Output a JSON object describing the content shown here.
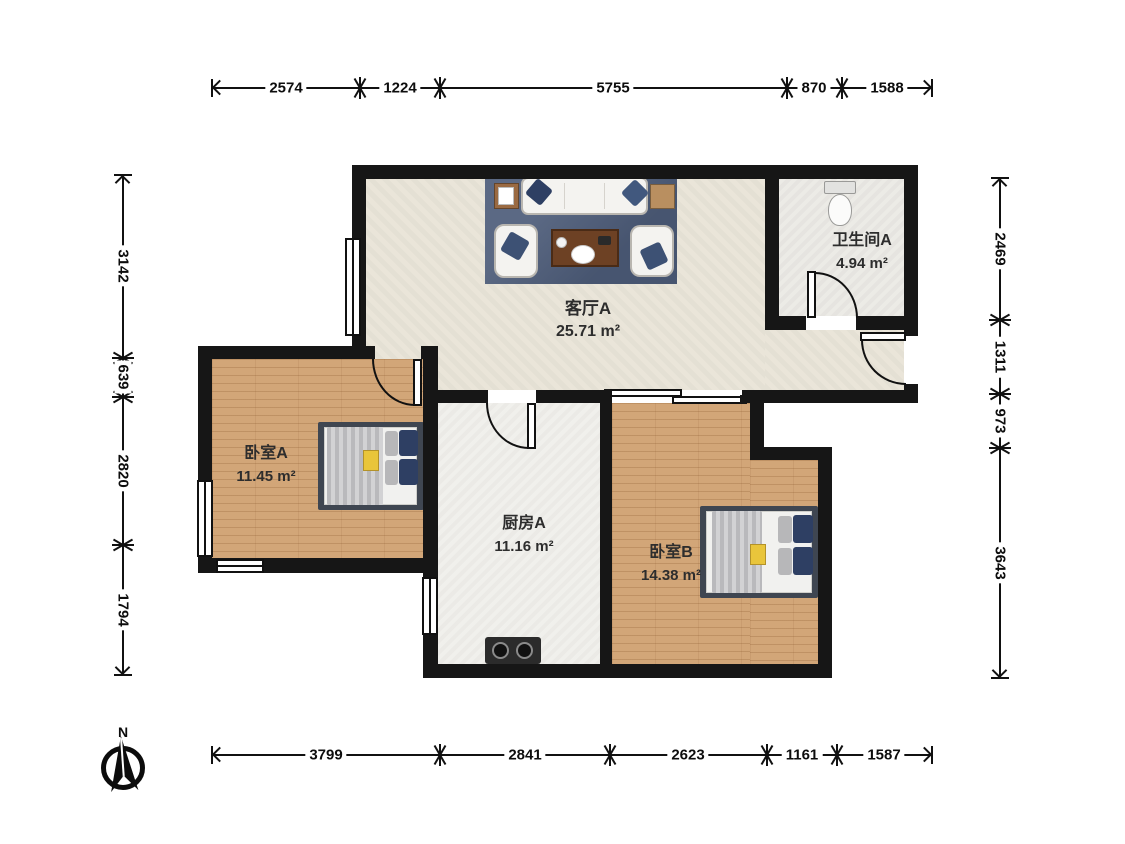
{
  "compass": {
    "north_label": "N"
  },
  "rooms": {
    "living": {
      "name": "客厅A",
      "area": "25.71 m²"
    },
    "bathroom": {
      "name": "卫生间A",
      "area": "4.94 m²"
    },
    "bedroom_a": {
      "name": "卧室A",
      "area": "11.45 m²"
    },
    "kitchen": {
      "name": "厨房A",
      "area": "11.16 m²"
    },
    "bedroom_b": {
      "name": "卧室B",
      "area": "14.38 m²"
    }
  },
  "dimensions_mm": {
    "top": [
      "2574",
      "1224",
      "5755",
      "870",
      "1588"
    ],
    "bottom": [
      "3799",
      "2841",
      "2623",
      "1161",
      "1587"
    ],
    "left": [
      "3142",
      "639",
      "2820",
      "1794"
    ],
    "right": [
      "2469",
      "1311",
      "973",
      "3643"
    ]
  },
  "colors": {
    "wall": "#161616",
    "line": "#111111",
    "living_floor": "#e9e4d8",
    "bath_floor": "#ebeae5",
    "kitchen_floor": "#f0efeb",
    "wood_floor": "#d2a678",
    "rug": "#4d5c79",
    "pillow_navy": "#2e3f63",
    "bed_frame": "#3f4651",
    "table_wood": "#6d4124",
    "accent_yellow": "#e9c53b"
  }
}
